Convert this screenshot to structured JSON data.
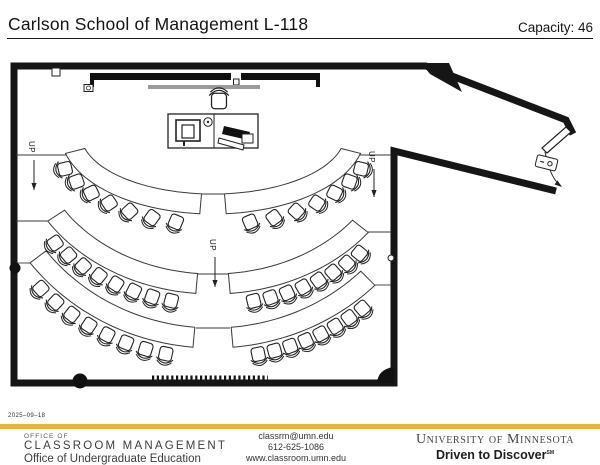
{
  "header": {
    "title": "Carlson School of Management L-118",
    "capacity": "Capacity: 46"
  },
  "plan": {
    "up_label": "UP",
    "up_markers": [
      {
        "tx": 29,
        "ty": 141,
        "ax": 34,
        "ay1": 160,
        "ay2": 190
      },
      {
        "tx": 210,
        "ty": 239,
        "ax": 215,
        "ay1": 257,
        "ay2": 287
      },
      {
        "tx": 369,
        "ty": 151,
        "ax": 374,
        "ay1": 169,
        "ay2": 197
      }
    ],
    "seating": {
      "center": {
        "x": 213,
        "y": 134
      },
      "total_seats": 46,
      "rows": [
        {
          "name": "row-1",
          "table": {
            "a_in": 132,
            "b_in": 60,
            "a_out": 152,
            "b_out": 80
          },
          "chairs": {
            "a": 162,
            "b": 92
          },
          "sections": [
            {
              "side": "left",
              "table_span": [
                95,
                166
              ],
              "chair_span": [
                99,
                162
              ],
              "seats": 7
            },
            {
              "side": "right",
              "table_span": [
                14,
                85
              ],
              "chair_span": [
                18,
                81
              ],
              "seats": 7
            }
          ]
        },
        {
          "name": "row-2",
          "table": {
            "a_in": 177,
            "b_in": 140,
            "a_out": 197,
            "b_out": 160
          },
          "chairs": {
            "a": 207,
            "b": 172
          },
          "sections": [
            {
              "side": "left",
              "table_span": [
                95,
                147
              ],
              "chair_span": [
                99,
                143
              ],
              "seats": 8
            },
            {
              "side": "right",
              "table_span": [
                38,
                85
              ],
              "chair_span": [
                42,
                81
              ],
              "seats": 8
            }
          ]
        },
        {
          "name": "row-3",
          "table": {
            "a_in": 209,
            "b_in": 194,
            "a_out": 229,
            "b_out": 214
          },
          "chairs": {
            "a": 239,
            "b": 226
          },
          "sections": [
            {
              "side": "left",
              "table_span": [
                95,
                143
              ],
              "chair_span": [
                99,
                139
              ],
              "seats": 8
            },
            {
              "side": "right",
              "table_span": [
                45,
                85
              ],
              "chair_span": [
                49,
                81
              ],
              "seats": 8
            }
          ]
        }
      ]
    },
    "tier_lines": [
      [
        16,
        155,
        66,
        155
      ],
      [
        16,
        221,
        48,
        221
      ],
      [
        16,
        263,
        30,
        263
      ],
      [
        360,
        155,
        391,
        155
      ],
      [
        368,
        232,
        391,
        232
      ],
      [
        375,
        285,
        391,
        285
      ],
      [
        196,
        194,
        230,
        194
      ],
      [
        196,
        274,
        230,
        274
      ],
      [
        196,
        328,
        230,
        328
      ]
    ]
  },
  "footer": {
    "date": "2025–09–18",
    "office_of": "OFFICE OF",
    "classroom_management": "CLASSROOM MANAGEMENT",
    "undergrad": "Office of Undergraduate Education",
    "email": "classrm@umn.edu",
    "phone": "612-625-1086",
    "web": "www.classroom.umn.edu",
    "university": "University of Minnesota",
    "driven": "Driven to Discover",
    "driven_sm": "SM",
    "gold_color": "#e9b43c"
  }
}
